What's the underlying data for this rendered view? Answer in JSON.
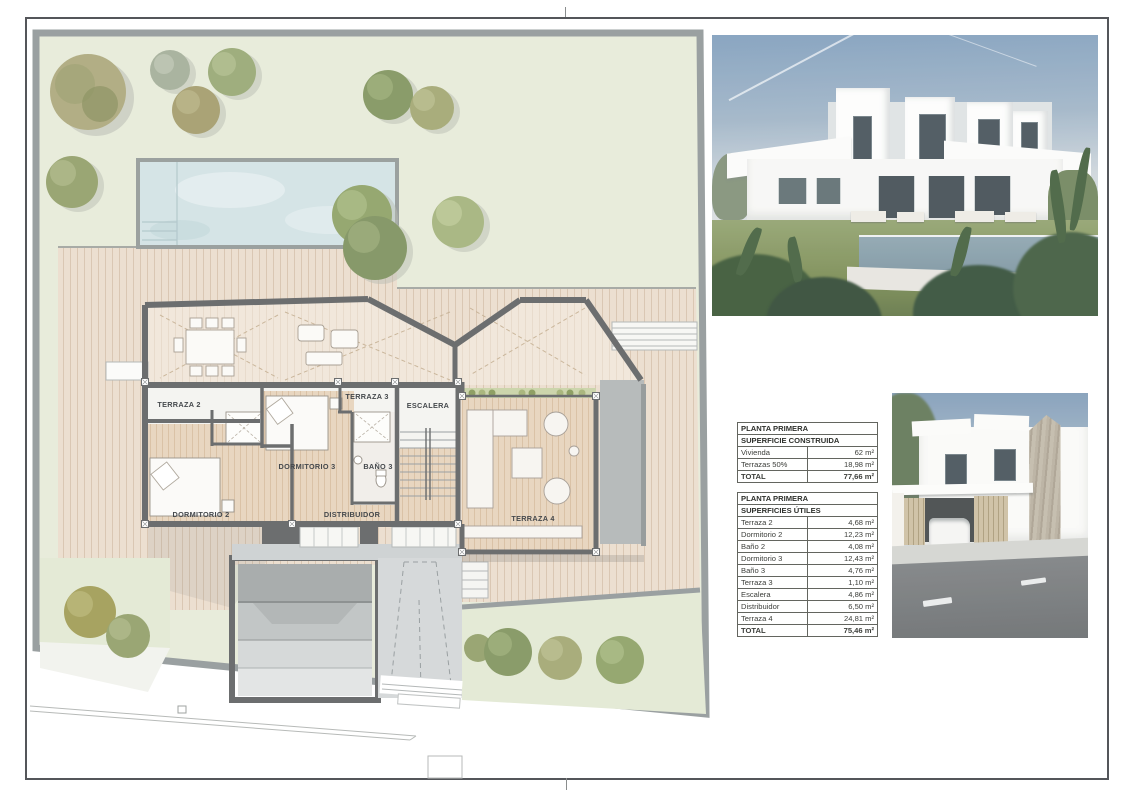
{
  "sheet": {
    "floor_plan": {
      "labels": {
        "terraza2": "TERRAZA 2",
        "terraza3": "TERRAZA 3",
        "terraza4": "TERRAZA 4",
        "dormitorio2": "DORMITORIO 2",
        "dormitorio3": "DORMITORIO 3",
        "bano3": "BAÑO 3",
        "escalera": "ESCALERA",
        "distribuidor": "DISTRIBUIDOR"
      }
    },
    "tables": {
      "construida": {
        "title": "PLANTA PRIMERA",
        "subtitle": "SUPERFICIE CONSTRUIDA",
        "rows": [
          {
            "label": "Vivienda",
            "value": "62 m²"
          },
          {
            "label": "Terrazas 50%",
            "value": "18,98 m²"
          }
        ],
        "total": {
          "label": "TOTAL",
          "value": "77,66 m²"
        }
      },
      "utiles": {
        "title": "PLANTA PRIMERA",
        "subtitle": "SUPERFICIES ÚTILES",
        "rows": [
          {
            "label": "Terraza 2",
            "value": "4,68 m²"
          },
          {
            "label": "Dormitorio 2",
            "value": "12,23 m²"
          },
          {
            "label": "Baño 2",
            "value": "4,08 m²"
          },
          {
            "label": "Dormitorio 3",
            "value": "12,43 m²"
          },
          {
            "label": "Baño 3",
            "value": "4,76 m²"
          },
          {
            "label": "Terraza 3",
            "value": "1,10 m²"
          },
          {
            "label": "Escalera",
            "value": "4,86 m²"
          },
          {
            "label": "Distribuidor",
            "value": "6,50 m²"
          },
          {
            "label": "Terraza 4",
            "value": "24,81 m²"
          }
        ],
        "total": {
          "label": "TOTAL",
          "value": "75,46 m²"
        }
      }
    },
    "colors": {
      "garden_green": "#e8ecdb",
      "deck_tan": "#ecdfd0",
      "room_wood": "#e8d6c0",
      "pool_water": "#d5e4e6",
      "wall_gray": "#6c6e6f",
      "plot_border": "#9aa0a1",
      "sky_blue": "#7d9cbb",
      "lawn_green": "#77894f",
      "road_gray": "#6f7375"
    }
  }
}
